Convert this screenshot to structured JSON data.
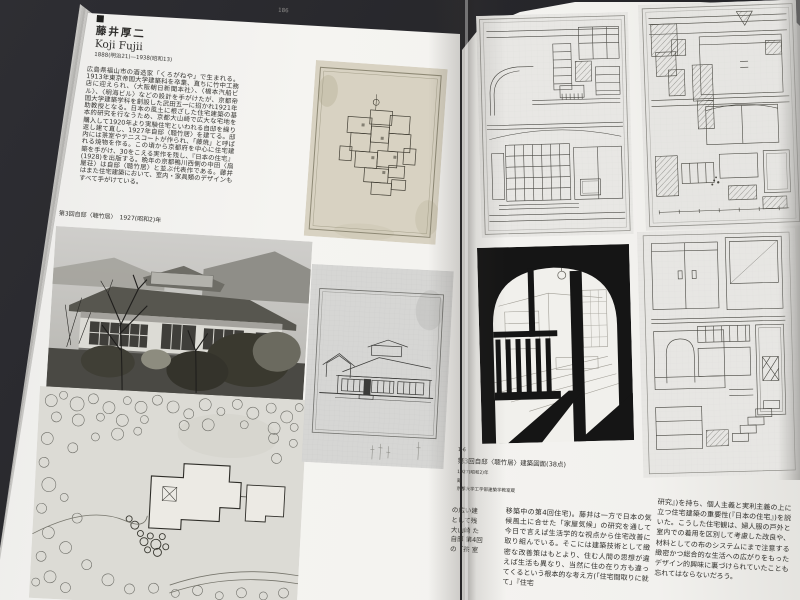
{
  "colors": {
    "background": "#2a2a2e",
    "page": "#f3f2ef",
    "ink": "#2e2d2b",
    "drawing_paper_aged": "#d8d2c2",
    "drawing_paper_grey": "#e6e5e2"
  },
  "book": {
    "left_page": {
      "page_number": "186",
      "header": {
        "name": "藤井厚二",
        "romanized": "Koji Fujii",
        "dates": "1888(明治21)—1938(昭和13)"
      },
      "bio": "広島県福山市の酒造家「くろがねや」で生まれる。1913年東京帝国大学建築科を卒業、直ちに竹中工務店に迎えられ、〈大阪朝日新聞本社〉、〈橋本汽船ビル〉、〈明海ビル〉などの設計を手がけたが、京都帝国大学建築学科を創設した武田五一に招かれ1921年助教授となる。日本の風土に根ざした住宅建築の基本的研究を行なうため、京都大山崎で広大な宅地を購入して1920年より実験住宅といわれる自邸を繰り返し建て直し、1927年自邸〈聴竹居〉を建てる。邸内には茶室やテニスコートが作られ、「藤焼」と呼ばれる焼物を作る。この頃から京都府を中心に住宅建築を手がけ、30をこえる実作を残し、『日本の住宅』(1928)を出版する。晩年の京都鴨川西側の中田〈扇屋荘〉は自邸〈聴竹居〉と並ぶ代表作である。藤井はまた住宅建築において、室内・家具類のデザインもすべて手がけている。",
      "photo_caption": "第3回自邸〈聴竹居〉　1927(昭和2)年"
    },
    "right_page": {
      "figure_caption": {
        "number": "1-6",
        "title": "第3回自邸〈聴竹居〉建築図面(38点)",
        "year": "1927(昭和2)年",
        "mark": "蔵",
        "credit": "京都大学工学部建築学教室蔵"
      },
      "body_fragment": "の広い建 として残 大山崎 た自邸 第4回 の『茶 室",
      "body_column_1": "移築中の第4回住宅)。藤井は一方で日本の気候風土に合せた「家屋気候」の研究を通して今日で言えば生活学的な視点から住宅改善に取り組んでいる。そこには建築技術として緻密な改善策はもとより、住む人間の思想が違えば生活も異なり、当然に住の在り方も違ってくるという根本的な考え方(「住宅間取りに就て」『住宅",
      "body_column_2": "研究』)を持ち、個人主義と実利主義の上に立つ住宅建築の重要性(『日本の住宅』)を説いた。こうした住宅観は、婦人服の戸外と室内での着用を区別して考慮した改良や、材料としての布のシステムにまで注意する緻密かつ総合的な生活への広がりをもったデザイン的興味に裏づけられていたことも忘れてはならないだろう。"
    }
  }
}
